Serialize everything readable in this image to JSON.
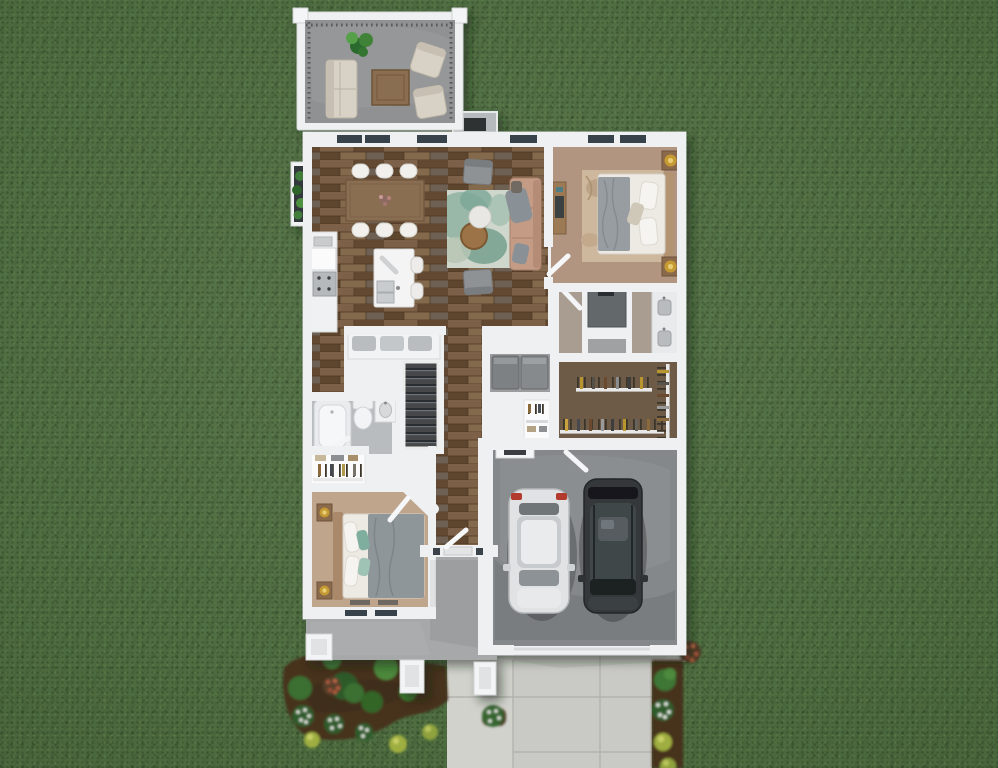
{
  "scene": {
    "type": "3d-rendered-floor-plan-top-view",
    "setting": "single-story house on a green lawn with driveway and flower beds",
    "rooms": [
      {
        "id": "deck"
      },
      {
        "id": "great-room"
      },
      {
        "id": "dining-area"
      },
      {
        "id": "kitchen"
      },
      {
        "id": "living-area"
      },
      {
        "id": "master-bedroom"
      },
      {
        "id": "master-bathroom"
      },
      {
        "id": "walk-in-closet"
      },
      {
        "id": "laundry"
      },
      {
        "id": "hall-bathroom"
      },
      {
        "id": "stairs"
      },
      {
        "id": "bedroom-2"
      },
      {
        "id": "bedroom-2-closet"
      },
      {
        "id": "entry-hall"
      },
      {
        "id": "front-porch"
      },
      {
        "id": "garage"
      },
      {
        "id": "driveway"
      },
      {
        "id": "walkway"
      },
      {
        "id": "flower-beds"
      }
    ],
    "vehicles": [
      {
        "id": "white-car",
        "color": "#e0e2e3"
      },
      {
        "id": "dark-suv",
        "color": "#34383b"
      }
    ]
  },
  "palette": {
    "grass": "#4e6d40",
    "wall": "#eef0f1",
    "wood_floor": "#6f563e",
    "deck_concrete": "#8f9193",
    "porch_concrete": "#a6a8a9",
    "garage_floor": "#84888b",
    "driveway": "#c9c9c5",
    "walkway": "#d2d2cd",
    "master_carpet": "#b29580",
    "bedroom2_carpet": "#c0a58d",
    "closet_floor": "#6d5a47",
    "bath_floor": "#b9bcbe",
    "master_bath_floor": "#a89d90",
    "living_rug": "#cfd6cb",
    "master_rug": "#cdb79d",
    "sofa": "#c49b85",
    "bed_linen": "#edeae4",
    "blanket": "#979da1",
    "white_car": "#e0e2e3",
    "dark_suv": "#34383b",
    "mulch": "#47331f",
    "shrub": "#3e7434",
    "flower_white": "#edf2e8",
    "flower_coral": "#b65a41",
    "flower_yellow": "#9fae3f",
    "table_wood": "#8a6e51",
    "lamp_gold": "#c59a33"
  }
}
